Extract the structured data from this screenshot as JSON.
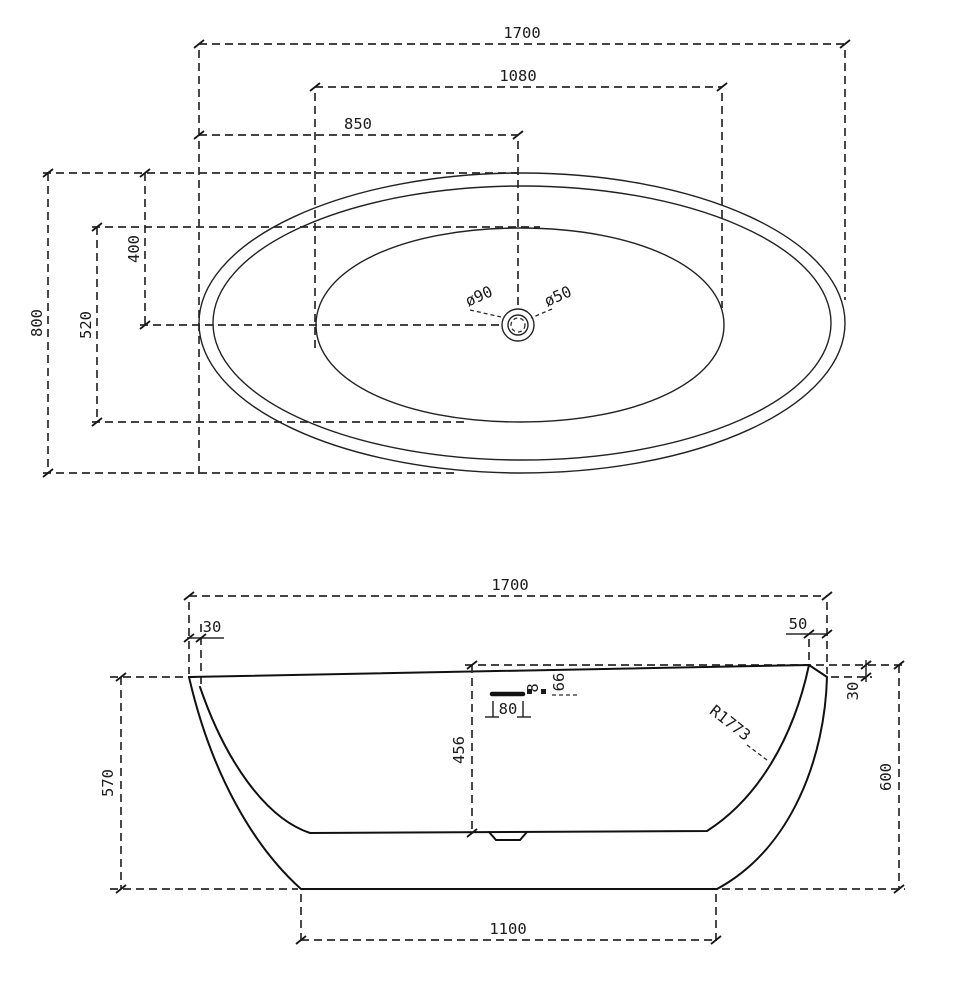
{
  "colors": {
    "line": "#1b1b1b",
    "background": "#ffffff"
  },
  "top_view": {
    "length_overall": "1700",
    "length_basin": "1080",
    "length_half": "850",
    "width_overall": "800",
    "width_basin": "520",
    "width_half": "400",
    "drain_outer_diameter": "ø90",
    "drain_waste_diameter": "ø50"
  },
  "side_view": {
    "length_overall": "1700",
    "rim_inset_left": "30",
    "rim_inset_right": "50",
    "rim_drop_right": "30",
    "height_left": "570",
    "height_overall": "600",
    "inner_depth": "456",
    "overflow_width": "80",
    "overflow_slot_height": "8",
    "overflow_offset": "66",
    "side_radius": "R1773",
    "base_length": "1100"
  }
}
